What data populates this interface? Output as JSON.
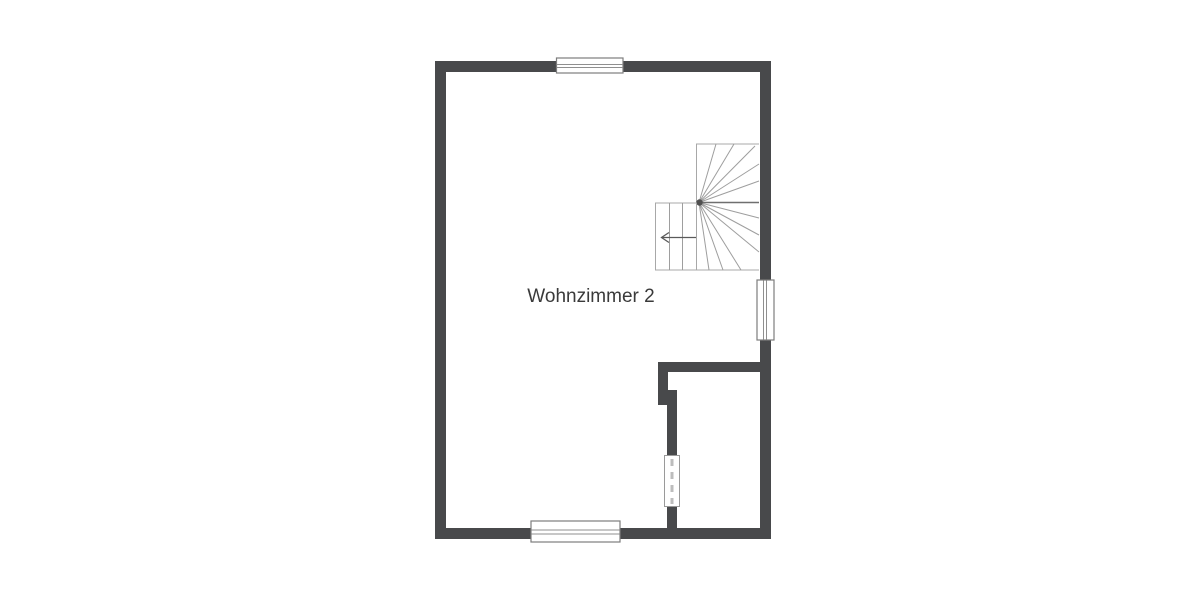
{
  "floorplan": {
    "room_label": "Wohnzimmer 2",
    "features": {
      "staircase": "winder-staircase-with-left-direction-arrow",
      "windows": [
        "top-wall-window",
        "right-wall-window",
        "bottom-wall-window",
        "interior-wall-window"
      ],
      "interior_room": "small-room-bottom-right"
    },
    "colors": {
      "background": "#ffffff",
      "wall": "#48494b",
      "window_frame": "#7d7d7d",
      "stair_lines": "#9e9e9e",
      "label_text": "#3a3a3a"
    }
  }
}
